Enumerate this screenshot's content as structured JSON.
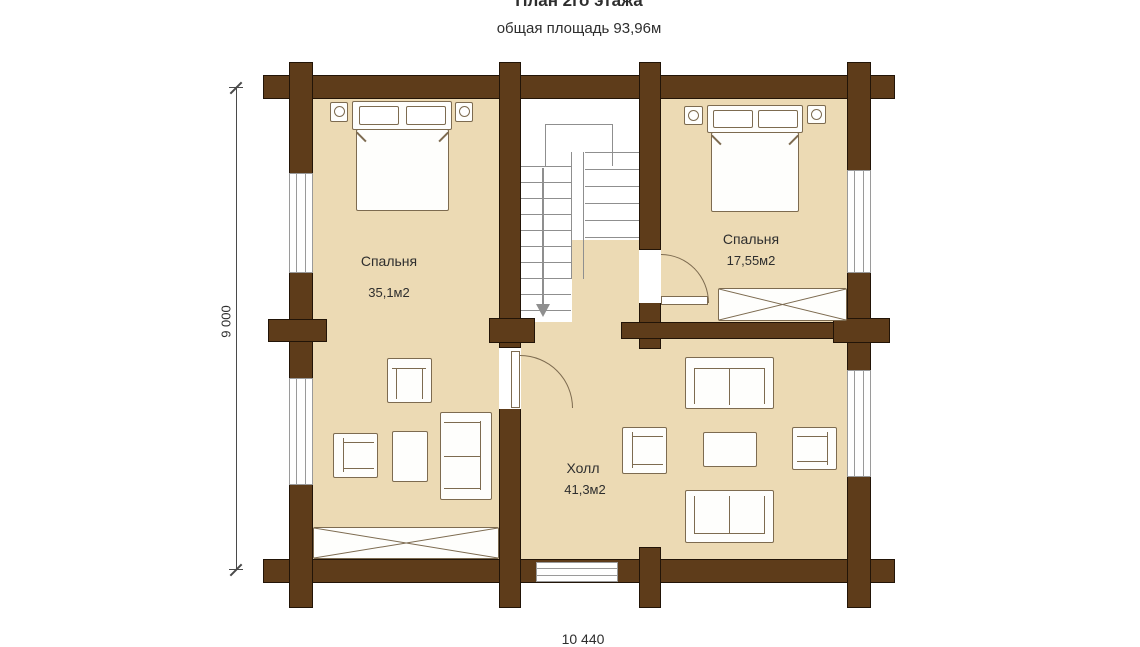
{
  "header": {
    "title": "План 2го этажа",
    "subtitle": "общая площадь 93,96м"
  },
  "rooms": {
    "bedroom_left": {
      "name": "Спальня",
      "area": "35,1м2"
    },
    "bedroom_right": {
      "name": "Спальня",
      "area": "17,55м2"
    },
    "hall": {
      "name": "Холл",
      "area": "41,3м2"
    }
  },
  "dimensions": {
    "left": "9 000",
    "bottom": "10 440"
  },
  "colors": {
    "wall": "#5e3c1a",
    "wall-edge": "#221407",
    "floor": "#ecdab4",
    "furn-line": "#7d6b50",
    "furn-fill": "#fefefc",
    "stair-line": "#8f8f8f",
    "win-line": "#9a9a9a",
    "dim-line": "#4a4a4a",
    "text": "#2e2e2e"
  }
}
